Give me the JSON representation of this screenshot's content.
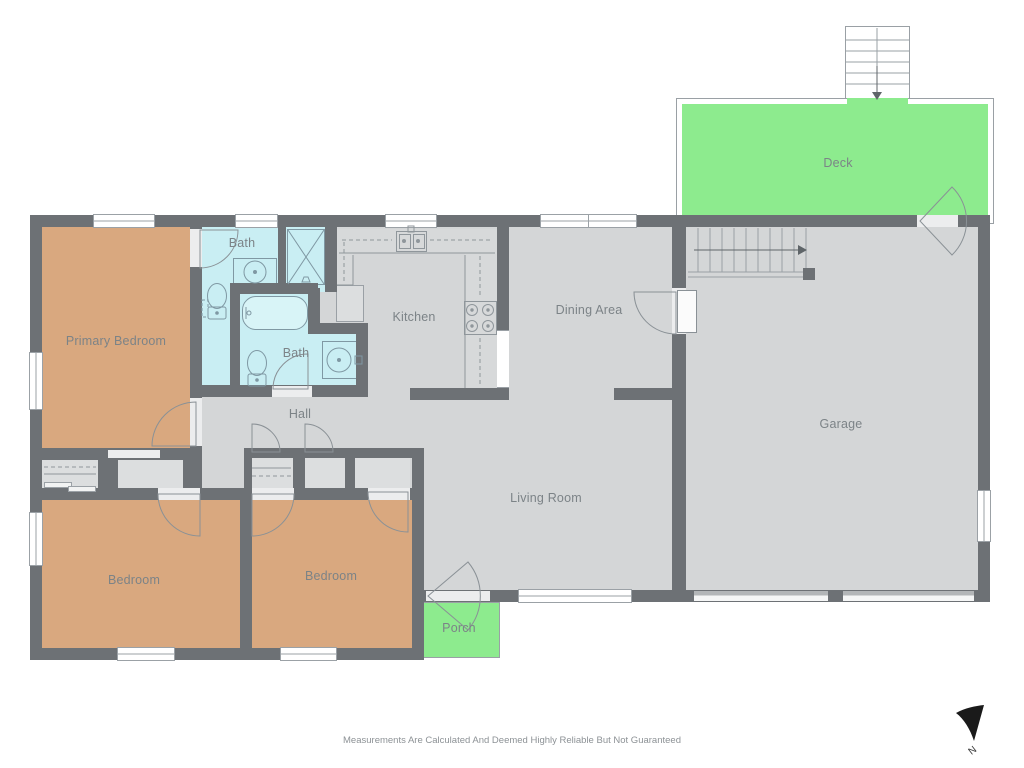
{
  "plan": {
    "rooms": {
      "primary_bedroom": "Primary Bedroom",
      "bath_ensuite": "Bath",
      "bath_hall": "Bath",
      "kitchen": "Kitchen",
      "dining": "Dining Area",
      "living": "Living Room",
      "hall": "Hall",
      "garage": "Garage",
      "deck": "Deck",
      "porch": "Porch",
      "bedroom_left": "Bedroom",
      "bedroom_middle": "Bedroom"
    },
    "colors": {
      "wall": "#6d7175",
      "floor": "#d4d6d7",
      "bedroom": "#d9a87f",
      "bath": "#c9eef3",
      "outdoor": "#8deb8e",
      "fixture_line": "#7f98a3"
    }
  },
  "compass": {
    "label": "N"
  },
  "footer": {
    "disclaimer": "Measurements Are Calculated And Deemed Highly Reliable But Not Guaranteed"
  }
}
